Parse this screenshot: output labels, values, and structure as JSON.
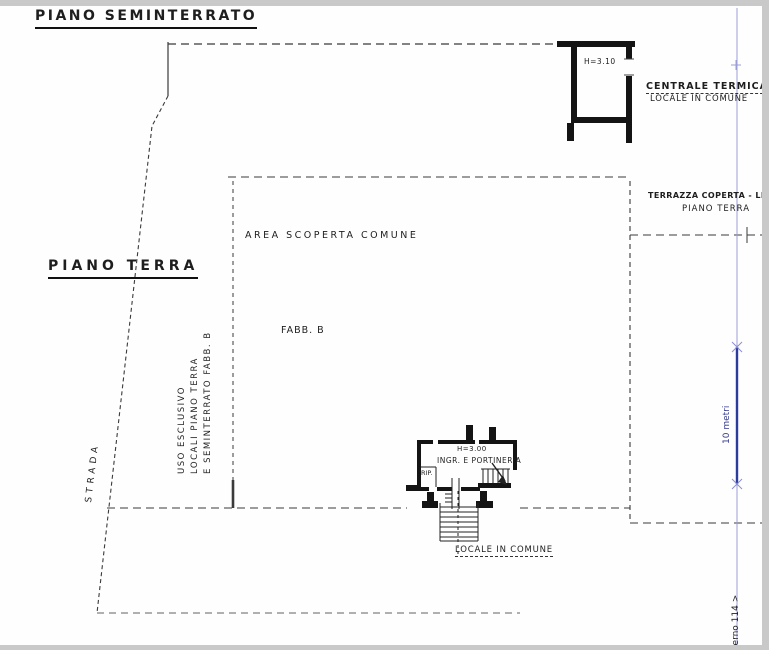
{
  "titles": {
    "basement": "PIANO SEMINTERRATO",
    "ground": "PIANO TERRA"
  },
  "labels": {
    "boiler_height": "H=3.10",
    "boiler_name": "CENTRALE TERMICA",
    "boiler_shared": "LOCALE IN COMUNE",
    "terrace_line1": "TERRAZZA COPERTA - LIV",
    "terrace_line2": "PIANO TERRA",
    "open_area": "AREA SCOPERTA COMUNE",
    "building": "FABB. B",
    "exclusive_use_line1": "USO ESCLUSIVO",
    "exclusive_use_line2": "LOCALI PIANO TERRA",
    "exclusive_use_line3": "E SEMINTERRATO FABB. B",
    "street": "STRADA",
    "entrance_height": "H=3.00",
    "entrance_room": "INGR. E PORTINERIA",
    "storage_room": "RIP.",
    "shared_room": "LOCALE IN COMUNE",
    "scale_bar": "10 metri",
    "margin_note": "terno 114 >"
  },
  "colors": {
    "ink": "#1e1e1e",
    "measure_blue": "#2c3c9c",
    "guide_blue": "#9a9dd8",
    "scan_edge": "#c9c9c9",
    "paper": "#fefefe"
  }
}
